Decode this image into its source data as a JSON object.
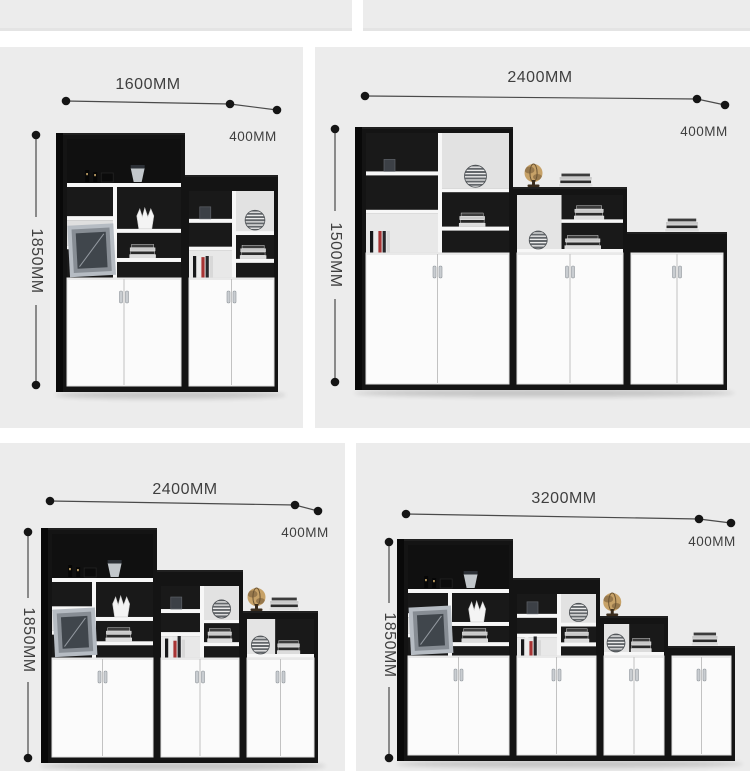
{
  "title": "Office file cabinet size combination diagram",
  "colors": {
    "panel_bg": "#ececec",
    "frame": "#141414",
    "frame_side": "#090909",
    "interior": "#191919",
    "interior_light": "#e4e4e4",
    "shelf": "#f7f7f7",
    "door": "#fbfbfb",
    "door_edge": "#e2e2e2",
    "door_seam": "#c2c2c2",
    "handle": "#c9cdd1",
    "handle_edge": "#8f959b",
    "text": "#3f3f3f",
    "line": "#4a4a4a",
    "dot": "#151515",
    "globe": "#c7a268",
    "globe_dark": "#97784c",
    "globe_stand": "#3a2c1c",
    "sphere": "#63676b",
    "sphere_stripe": "#ebebeb",
    "vase_gray": "#c2c7cb",
    "accent_red": "#a83434"
  },
  "panels": [
    {
      "name": "combo-1600mm",
      "width_label": "1600MM",
      "depth_label": "400MM",
      "height_label": "1850MM",
      "box": [
        0,
        47,
        303,
        381
      ],
      "ann": {
        "wline": [
          [
            66,
            54
          ],
          [
            230,
            57
          ],
          [
            277,
            63
          ]
        ],
        "vline": {
          "x": 36,
          "y1": 88,
          "y2": 338,
          "center": 214,
          "gap": 44
        }
      },
      "cabinet": {
        "x": [
          63,
          185
        ],
        "w": [
          122,
          93
        ],
        "top": [
          86,
          128
        ],
        "types": [
          "display",
          "grid"
        ],
        "door_top": 231,
        "bottom": 345,
        "deco_top": []
      }
    },
    {
      "name": "combo-2400mm-1500h",
      "width_label": "2400MM",
      "depth_label": "400MM",
      "height_label": "1500MM",
      "box": [
        315,
        47,
        435,
        381
      ],
      "ann": {
        "wline": [
          [
            50,
            49
          ],
          [
            382,
            52
          ],
          [
            410,
            58
          ]
        ],
        "vline": {
          "x": 20,
          "y1": 82,
          "y2": 335,
          "center": 208,
          "gap": 44
        }
      },
      "cabinet": {
        "x": [
          47,
          198,
          312
        ],
        "w": [
          151,
          114,
          100
        ],
        "top": [
          80,
          140,
          185
        ],
        "types": [
          "grid",
          "nook",
          "plain"
        ],
        "door_top": 206,
        "bottom": 343,
        "deco_top": [
          {
            "unit": 1,
            "items": [
              "globe",
              "books"
            ]
          },
          {
            "unit": 2,
            "items": [
              "books"
            ]
          }
        ]
      }
    },
    {
      "name": "combo-2400mm-1850h",
      "width_label": "2400MM",
      "depth_label": "400MM",
      "height_label": "1850MM",
      "box": [
        0,
        443,
        345,
        328
      ],
      "ann": {
        "wline": [
          [
            50,
            58
          ],
          [
            295,
            62
          ],
          [
            318,
            68
          ]
        ],
        "vline": {
          "x": 28,
          "y1": 89,
          "y2": 315,
          "center": 197,
          "gap": 42
        }
      },
      "cabinet": {
        "x": [
          48,
          157,
          243
        ],
        "w": [
          109,
          86,
          75
        ],
        "top": [
          85,
          127,
          168
        ],
        "types": [
          "display",
          "grid",
          "nook"
        ],
        "door_top": 215,
        "bottom": 320,
        "deco_top": [
          {
            "unit": 2,
            "items": [
              "globe",
              "books"
            ]
          }
        ]
      }
    },
    {
      "name": "combo-3200mm",
      "width_label": "3200MM",
      "depth_label": "400MM",
      "height_label": "1850MM",
      "box": [
        356,
        443,
        394,
        328
      ],
      "ann": {
        "wline": [
          [
            50,
            71
          ],
          [
            343,
            76
          ],
          [
            375,
            80
          ]
        ],
        "vline": {
          "x": 33,
          "y1": 99,
          "y2": 315,
          "center": 202,
          "gap": 42
        }
      },
      "cabinet": {
        "x": [
          48,
          157,
          244,
          312
        ],
        "w": [
          109,
          87,
          68,
          67
        ],
        "top": [
          96,
          135,
          173,
          203
        ],
        "types": [
          "display",
          "grid",
          "nook",
          "plain"
        ],
        "door_top": 213,
        "bottom": 318,
        "deco_top": [
          {
            "unit": 2,
            "items": [
              "globe"
            ]
          },
          {
            "unit": 3,
            "items": [
              "books"
            ]
          }
        ]
      }
    }
  ]
}
